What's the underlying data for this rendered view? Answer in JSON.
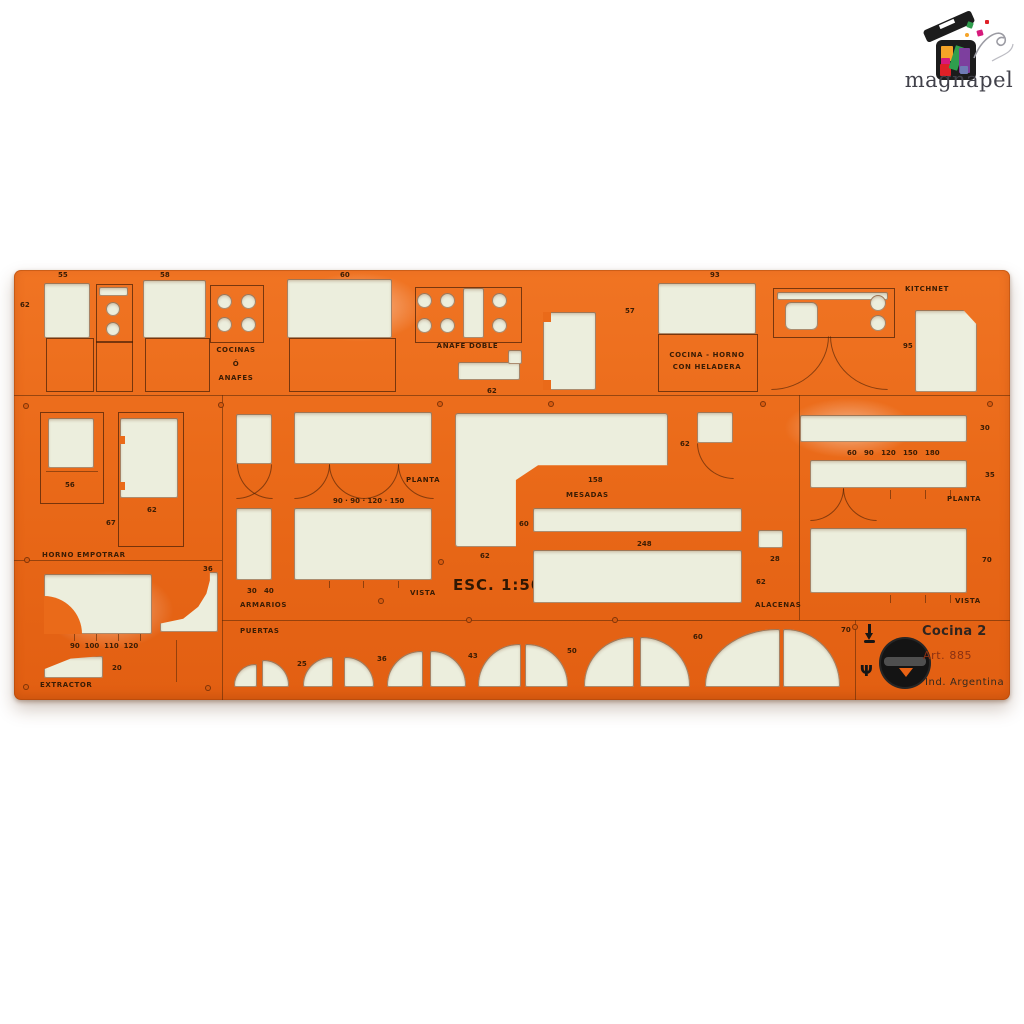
{
  "watermark": {
    "name": "magnapel"
  },
  "colors": {
    "plastic": "#ea6a19",
    "plastic_dark": "#d85c10",
    "cutout": "#eceedd",
    "line": "#4a2408",
    "brand_black": "#141414",
    "watermark_text": "#41414a"
  },
  "panel": {
    "title": "Cocina 2",
    "article": "Art. 885",
    "origin": "Ind. Argentina"
  },
  "labels": {
    "cocinas_1": "COCINAS",
    "cocinas_2": "Ó",
    "cocinas_3": "ANAFES",
    "anafe_doble": "ANAFE DOBLE",
    "cocina_horno_1": "COCINA - HORNO",
    "cocina_horno_2": "CON HELADERA",
    "kitchnet": "KITCHNET",
    "horno_empotrar": "HORNO EMPOTRAR",
    "extractor": "EXTRACTOR",
    "armarios": "ARMARIOS",
    "mesadas": "MESADAS",
    "alacenas": "ALACENAS",
    "puertas": "PUERTAS",
    "planta_armarios": "PLANTA",
    "vista_armarios": "VISTA",
    "planta_alacenas": "PLANTA",
    "vista_alacenas": "VISTA",
    "escala": "ESC. 1:50"
  },
  "numbers": {
    "top_1": "55",
    "top_2": "58",
    "top_3": "60",
    "edge_left": "62",
    "anafe_62": "62",
    "heladera_57": "57",
    "horno_93": "93",
    "kitchnet_95": "95",
    "emp_56": "56",
    "emp_62": "62",
    "emp_67": "67",
    "ext_sizes": "90  100  110  120",
    "ext_36": "36",
    "ext_20": "20",
    "arm_sizes": "90 · 90 · 120 · 150",
    "arm_depths": "30   40",
    "mes_62a": "62",
    "mes_158": "158",
    "mes_60": "60",
    "mes_62b": "62",
    "mes_248": "248",
    "ala_30": "30",
    "ala_sizes": "60   90   120   150   180",
    "ala_35": "35",
    "ala_70": "70",
    "ala_28": "28",
    "ala_62": "62",
    "pue_1": "25",
    "pue_2": "36",
    "pue_3": "43",
    "pue_4": "50",
    "pue_5": "60",
    "pue_6": "70"
  }
}
